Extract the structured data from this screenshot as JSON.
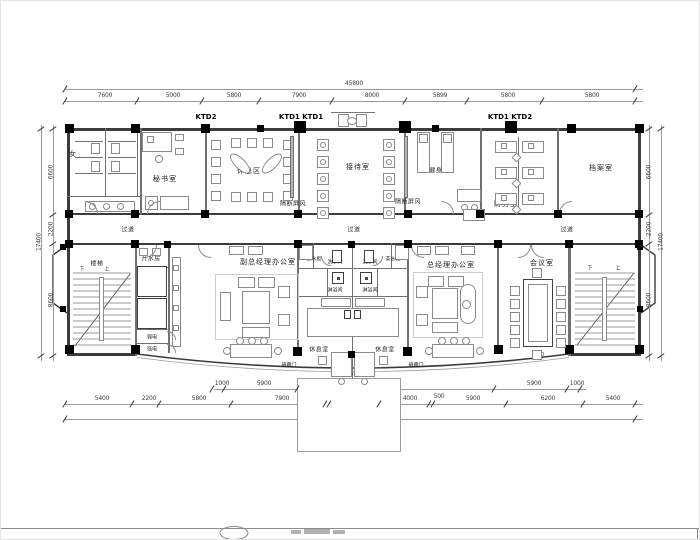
{
  "sheet": {
    "background": "#ffffff",
    "line_color": "#3c3c3c"
  },
  "axis_labels": {
    "ktd2": "KTD2",
    "ktd1_ktd1": "KTD1 KTD1",
    "ktd1_ktd2": "KTD1 KTD2"
  },
  "dimensions": {
    "overall_width": "45800",
    "overall_height": "17400",
    "top_segments": [
      "7600",
      "5000",
      "5800",
      "7900",
      "8000",
      "5899",
      "5800",
      "5800"
    ],
    "bottom_inner": [
      "1000",
      "5900",
      "24200",
      "5900",
      "1000"
    ],
    "bottom_segments": [
      "5400",
      "2200",
      "5800",
      "7900",
      "500",
      "4000",
      "4000",
      "500",
      "5900",
      "6200",
      "5400"
    ],
    "side_segments": [
      "6600",
      "2200",
      "8600"
    ],
    "meeting_table_dim": "1400"
  },
  "rooms": {
    "women": "女",
    "men": "男",
    "washroom": "洗手间",
    "secretary": "秘书室",
    "lounge": "休息区",
    "screen": "隔断屏风",
    "reception": "接待室",
    "gym": "健身区",
    "finance": "财务室",
    "archive": "档案室",
    "corridor": "过道",
    "stairs": "楼梯",
    "hot_water": "开水房",
    "weak_power": "弱电",
    "strong_power": "强电",
    "deputy_gm_office": "副总经理办公室",
    "gm_office": "总经理办公室",
    "meeting_room": "会议室",
    "tea_cabinet": "茶水柜",
    "shower": "淋浴间",
    "rest_room": "休息室",
    "desk": "书桌",
    "hidden_door": "暗藏门",
    "up": "上",
    "down": "下"
  }
}
